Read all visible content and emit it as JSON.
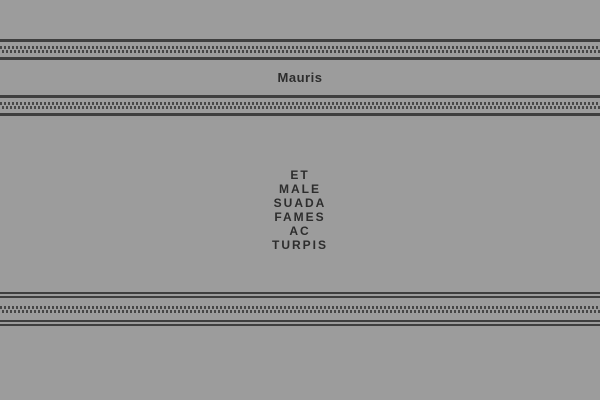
{
  "page": {
    "background_color": "#9c9c9c",
    "rule_line_color": "#3f3f3f",
    "rule_dot_color": "#474747",
    "text_color": "#2d2d2d"
  },
  "header": {
    "title": "Mauris"
  },
  "nav": {
    "items": [
      {
        "label": "ET"
      },
      {
        "label": "MALE"
      },
      {
        "label": "SUADA"
      },
      {
        "label": "FAMES"
      },
      {
        "label": "AC"
      },
      {
        "label": "TURPIS"
      }
    ]
  }
}
